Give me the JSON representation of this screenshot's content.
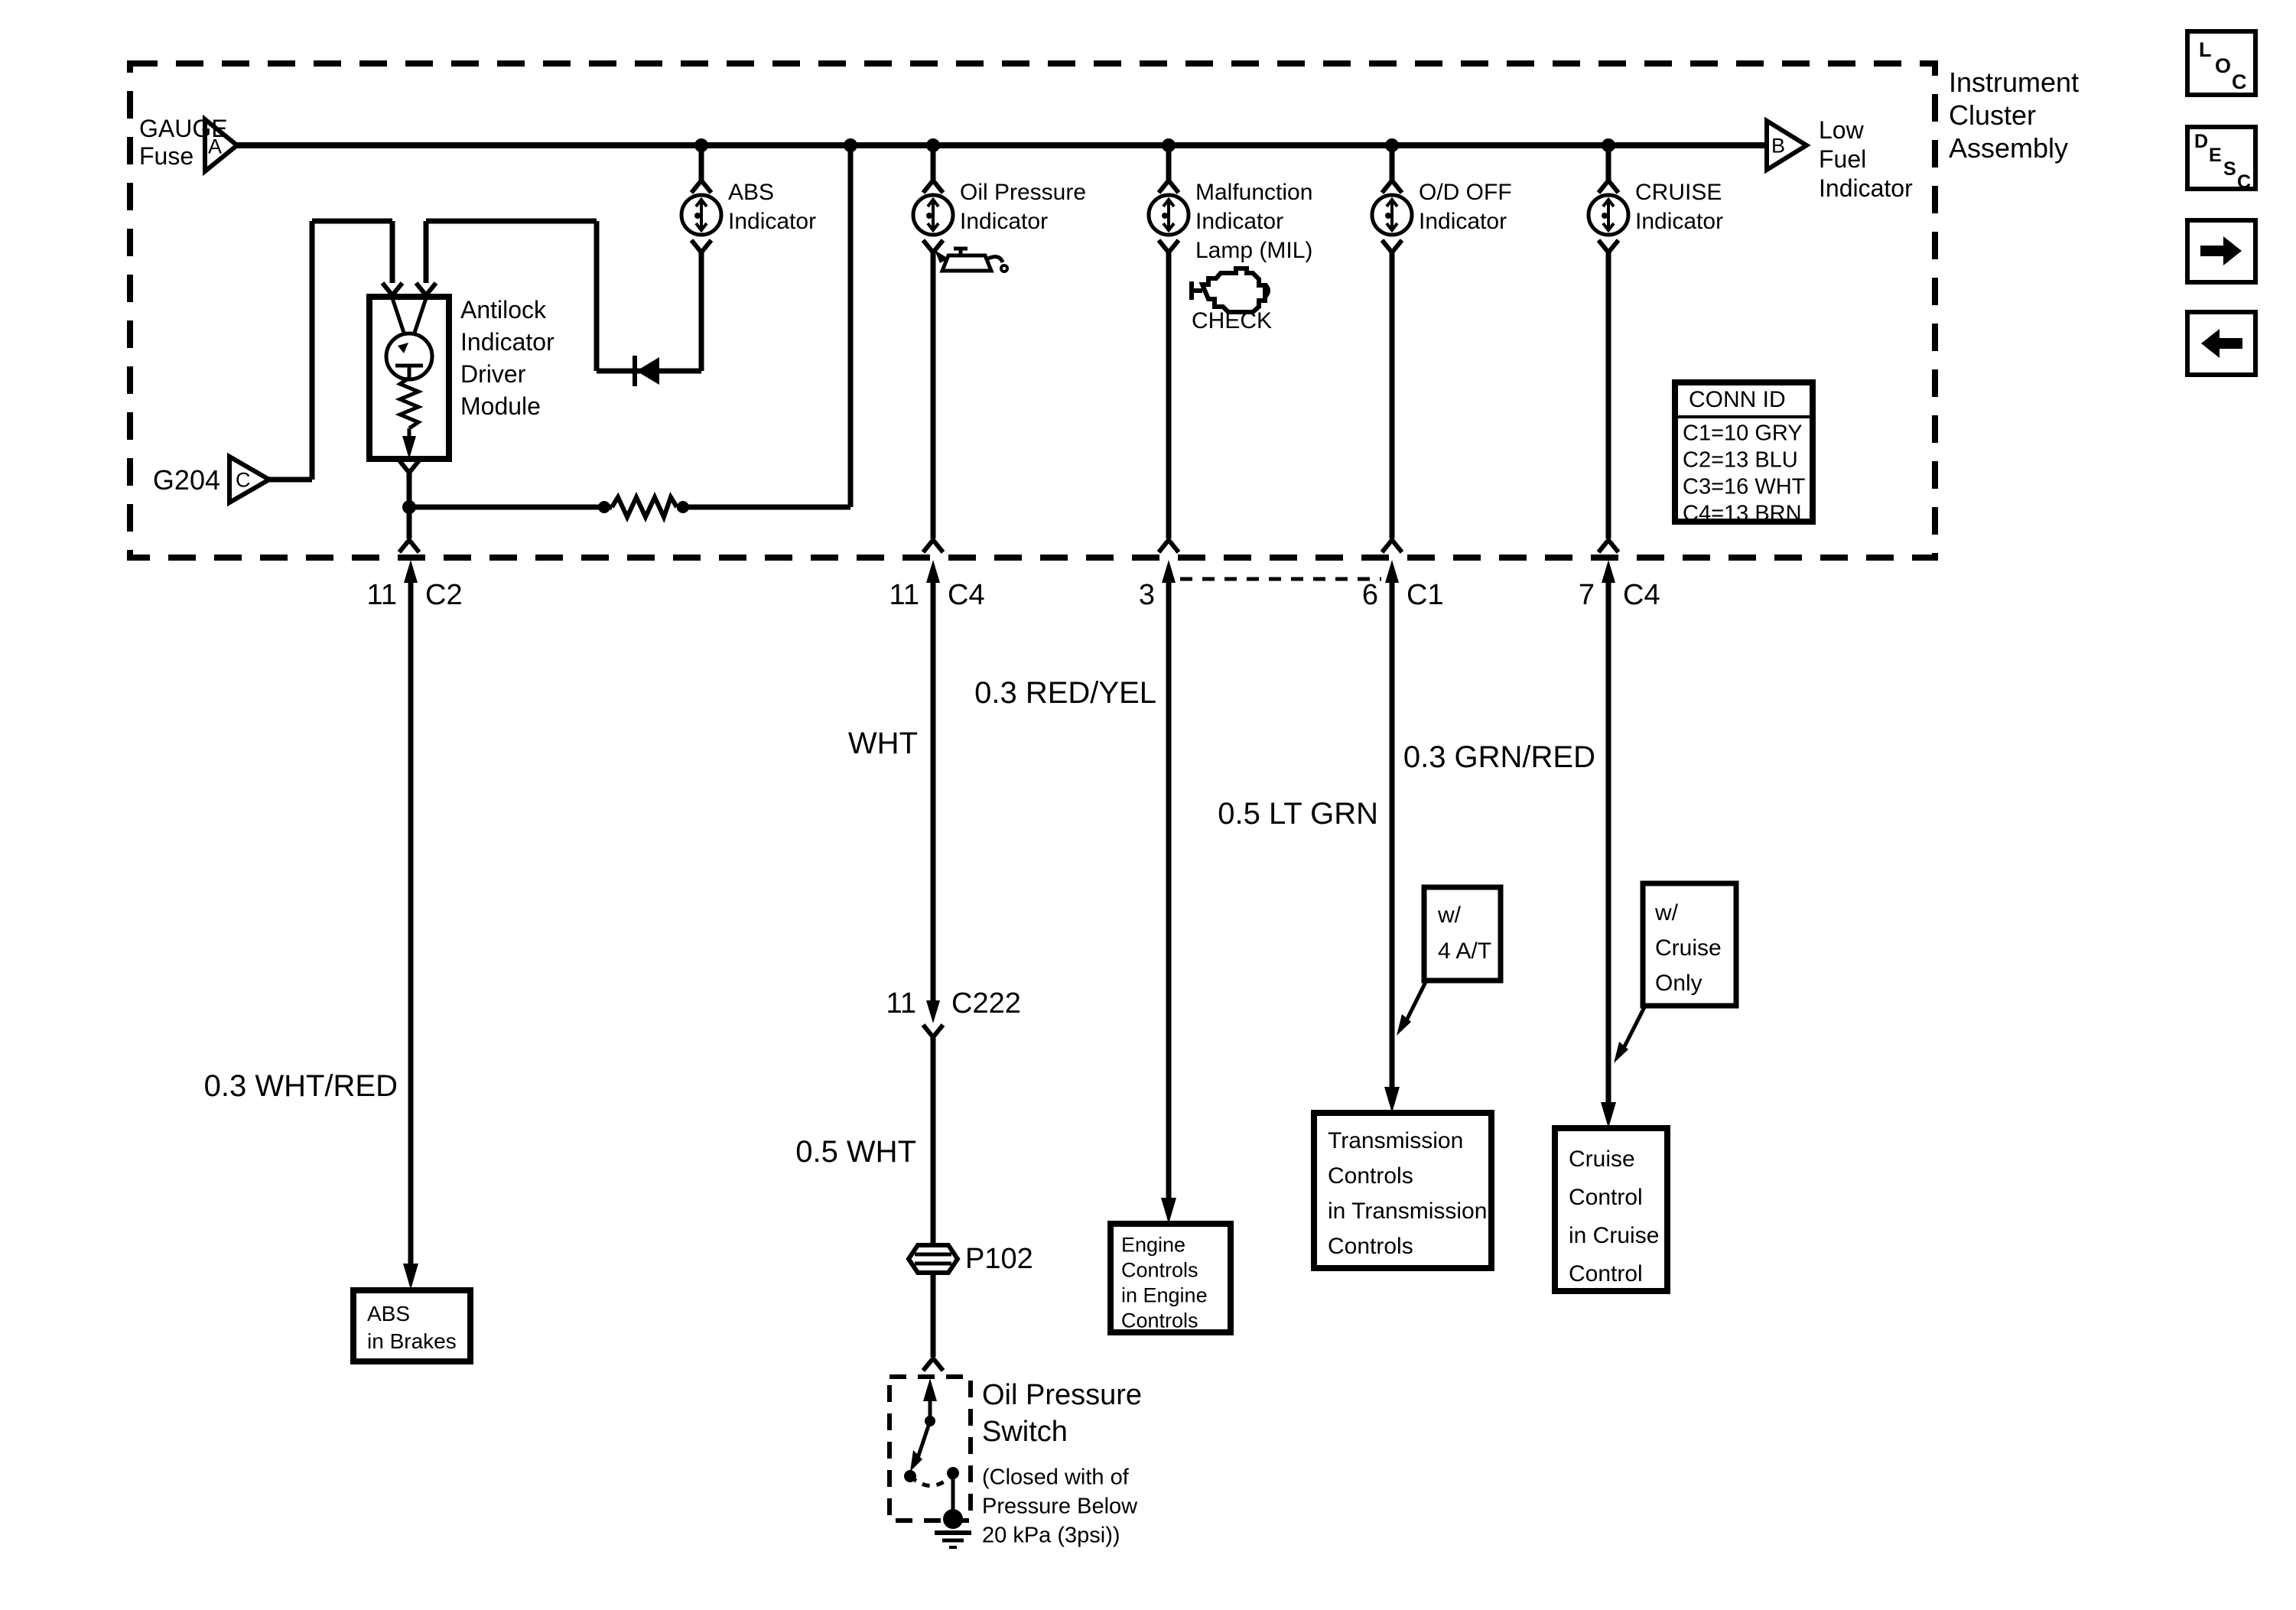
{
  "cluster": {
    "title_line1": "Instrument",
    "title_line2": "Cluster",
    "title_line3": "Assembly",
    "conn_id": {
      "header": "CONN ID",
      "r1": "C1=10 GRY",
      "r2": "C2=13 BLU",
      "r3": "C3=16 WHT",
      "r4": "C4=13 BRN"
    }
  },
  "power": {
    "fuse_line1": "GAUGE",
    "fuse_line2": "Fuse",
    "terminal_a": "A",
    "terminal_b": "B",
    "terminal_c": "C",
    "ground_label": "G204",
    "low_fuel_line1": "Low",
    "low_fuel_line2": "Fuel",
    "low_fuel_line3": "Indicator"
  },
  "module": {
    "line1": "Antilock",
    "line2": "Indicator",
    "line3": "Driver",
    "line4": "Module"
  },
  "indicators": {
    "abs": {
      "line1": "ABS",
      "line2": "Indicator"
    },
    "oil": {
      "line1": "Oil Pressure",
      "line2": "Indicator",
      "icon": "oil-can-icon"
    },
    "mil": {
      "line1": "Malfunction",
      "line2": "Indicator",
      "line3": "Lamp (MIL)",
      "check": "CHECK",
      "icon": "check-engine-icon"
    },
    "od": {
      "line1": "O/D OFF",
      "line2": "Indicator"
    },
    "cruise": {
      "line1": "CRUISE",
      "line2": "Indicator"
    }
  },
  "connectors": {
    "c2": {
      "pin": "11",
      "name": "C2"
    },
    "c4_oil": {
      "pin": "11",
      "name": "C4"
    },
    "pin3": {
      "pin": "3"
    },
    "c1": {
      "pin": "6",
      "name": "C1"
    },
    "c4_cruise": {
      "pin": "7",
      "name": "C4"
    },
    "c222": {
      "pin": "11",
      "name": "C222"
    },
    "p102": {
      "name": "P102"
    }
  },
  "wires": {
    "abs": "0.3 WHT/RED",
    "oil_upper": "WHT",
    "oil_lower": "0.5 WHT",
    "mil": "0.3 RED/YEL",
    "od": "0.5 LT GRN",
    "cruise": "0.3 GRN/RED"
  },
  "destinations": {
    "abs": {
      "line1": "ABS",
      "line2": "in Brakes"
    },
    "engine": {
      "line1": "Engine",
      "line2": "Controls",
      "line3": "in Engine",
      "line4": "Controls"
    },
    "trans": {
      "line1": "Transmission",
      "line2": "Controls",
      "line3": "in Transmission",
      "line4": "Controls"
    },
    "cruise": {
      "line1": "Cruise",
      "line2": "Control",
      "line3": "in Cruise",
      "line4": "Control"
    }
  },
  "annotations": {
    "at": {
      "line1": "w/",
      "line2": "4 A/T"
    },
    "cruise_only": {
      "line1": "w/",
      "line2": "Cruise",
      "line3": "Only"
    }
  },
  "oil_switch": {
    "title_line1": "Oil Pressure",
    "title_line2": "Switch",
    "desc_line1": "(Closed with of",
    "desc_line2": "Pressure Below",
    "desc_line3": "20 kPa (3psi))"
  },
  "toolbar": {
    "loc_l": "L",
    "loc_o": "O",
    "loc_c": "C",
    "desc_d": "D",
    "desc_e": "E",
    "desc_s": "S",
    "desc_c": "C"
  },
  "colors": {
    "ink": "#000000",
    "paper": "#ffffff"
  }
}
